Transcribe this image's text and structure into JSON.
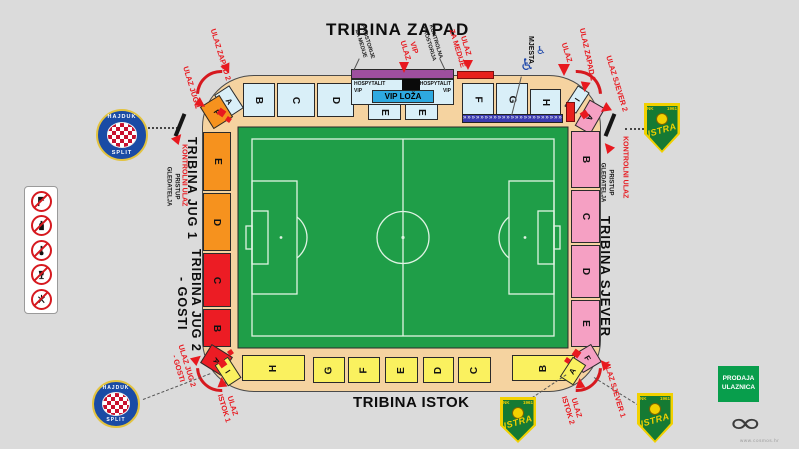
{
  "stands": {
    "west": {
      "title": "TRIBINA ZAPAD",
      "sections": [
        "A",
        "B",
        "C",
        "D",
        "E",
        "E",
        "F",
        "G",
        "H",
        "I"
      ]
    },
    "east": {
      "title": "TRIBINA ISTOK",
      "sections": [
        "I",
        "H",
        "G",
        "F",
        "E",
        "D",
        "C",
        "B",
        "A"
      ]
    },
    "north": {
      "title": "TRIBINA SJEVER",
      "sections": [
        "A",
        "B",
        "C",
        "D",
        "E",
        "F"
      ]
    },
    "south": {
      "title_jug1": "TRIBINA JUG 1",
      "title_jug2": "TRIBINA JUG 2",
      "title_gosti": "- GOSTI",
      "sections": [
        "F",
        "E",
        "D",
        "C",
        "B",
        "A"
      ]
    }
  },
  "vip": {
    "hospitality_left": "HOSPYTALIT\nVIP",
    "hospitality_right": "HOSPYTALIT\nVIP",
    "loza": "VIP LOŽA"
  },
  "facilities": {
    "media_rooms": "PROSTORIJE\nZA MEDIJE",
    "control_room": "KONTROLNA\nPROSTORIJA",
    "wheelchair_places": "MJESTA",
    "wheelchair_symbol": "♿",
    "media_strip": "»»»»»»»»»»»»»»»»»»»»»»»"
  },
  "entrances": {
    "jug1": "ULAZ JUG 1",
    "zapad2": "ULAZ ZAPAD 2",
    "vip": "VIP\nULAZ",
    "za_medije": "ULAZ\nZA MEDIJE",
    "ulaz": "ULAZ",
    "zapad1": "ULAZ ZAPAD 1",
    "sjever2": "ULAZ SJEVER 2",
    "kontrolni_right": "KONTROLNI ULAZ",
    "pristup_right": "PRISTUP\nGLEDATELJA",
    "kontrolni_left": "KONTROLNI ULAZ",
    "pristup_left": "PRISTUP\nGLEDATELJA",
    "sjever1": "ULAZ SJEVER 1",
    "istok2": "ULAZ\nISTOK 2",
    "istok1": "ULAZ\nISTOK 1",
    "jug2": "ULAZ JUG 2\n- GOSTI"
  },
  "ticketing": {
    "label": "PRODAJA\nULAZNICA"
  },
  "clubs": {
    "hajduk": {
      "top": "HAJDUK",
      "bottom": "SPLIT"
    },
    "istra": {
      "nk": "NK",
      "year": "1961",
      "name": "ISTRA"
    }
  },
  "watermark": {
    "symbol": "∞",
    "url": "www.cosmos.hr"
  },
  "colors": {
    "pitch_green": "#1F9E48",
    "west_blue": "#D9EFF8",
    "north_pink": "#F5A0C3",
    "east_yellow": "#FAF15F",
    "south_orange": "#F6921E",
    "guest_red": "#EC1C24",
    "vip_blue": "#2EA9E0",
    "media_purple": "#9E4F9E",
    "accent_red": "#E8191F",
    "ticket_green": "#089E4C",
    "concourse_tan": "#F5D3A0"
  }
}
